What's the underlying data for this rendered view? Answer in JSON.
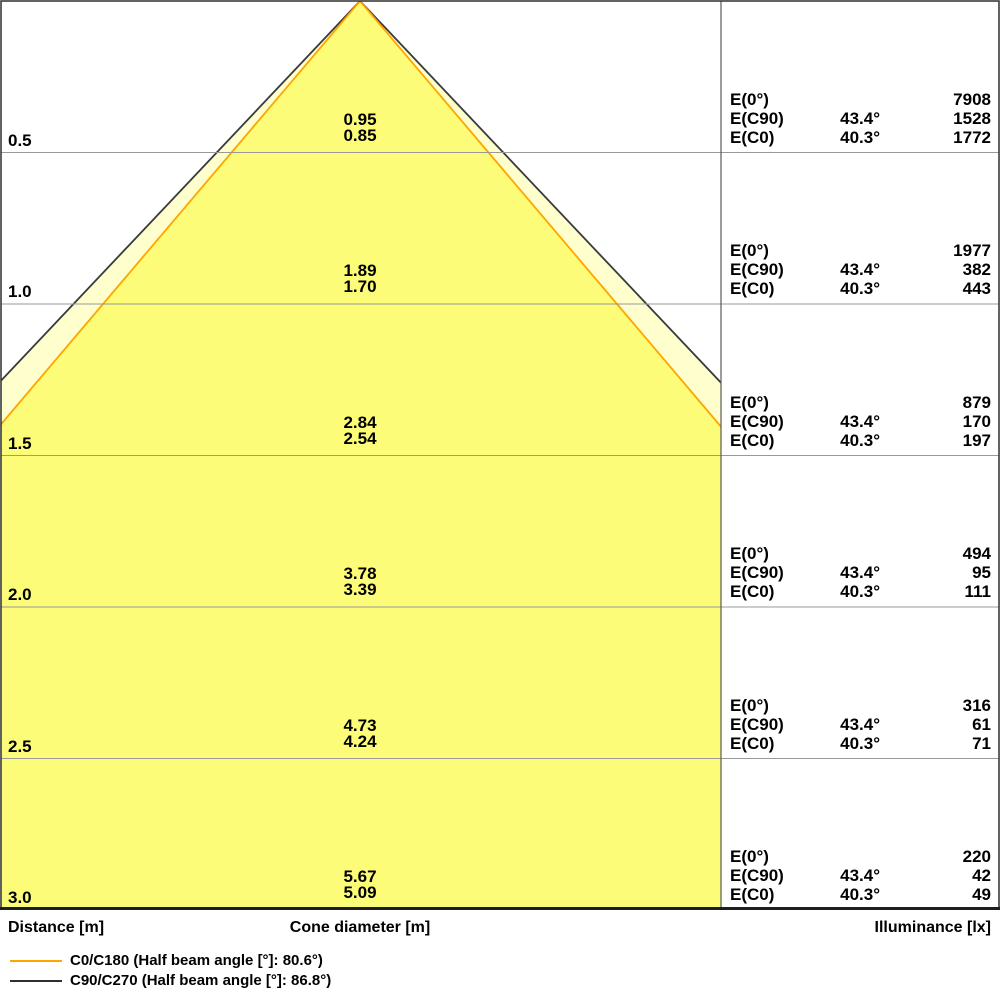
{
  "chart_data": {
    "type": "area",
    "title": "Light cone diagram (cone diameter and illuminance vs. distance)",
    "xlabel": "Distance [m]",
    "distances_m": [
      0.5,
      1.0,
      1.5,
      2.0,
      2.5,
      3.0
    ],
    "axis_ranges": {
      "distance_m": [
        0,
        3.0
      ]
    },
    "grid": true,
    "series": [
      {
        "name": "C90/C270",
        "half_beam_angle_deg": 86.8,
        "half_angle_deg": 43.4,
        "cone_diameter_m": [
          0.95,
          1.89,
          2.84,
          3.78,
          4.73,
          5.67
        ],
        "illuminance_lx": [
          1528,
          382,
          170,
          95,
          61,
          42
        ],
        "line_color": "#3A3A3A",
        "fill_color": "#FFFFCE"
      },
      {
        "name": "C0/C180",
        "half_beam_angle_deg": 80.6,
        "half_angle_deg": 40.3,
        "cone_diameter_m": [
          0.85,
          1.7,
          2.54,
          3.39,
          4.24,
          5.09
        ],
        "illuminance_lx": [
          1772,
          443,
          197,
          111,
          71,
          49
        ],
        "line_color": "#FFA500",
        "fill_color": "#FCFC78"
      }
    ],
    "E0_lx": [
      7908,
      1977,
      879,
      494,
      316,
      220
    ],
    "legend_position": "bottom-left"
  },
  "axes": {
    "distance": "Distance [m]",
    "cone_diameter": "Cone diameter [m]",
    "illuminance": "Illuminance [lx]"
  },
  "table": {
    "e0_label": "E(0°)",
    "ec90_label": "E(C90)",
    "ec0_label": "E(C0)",
    "ec90_angle": "43.4°",
    "ec0_angle": "40.3°",
    "blocks": [
      {
        "distance": "0.5",
        "d_outer": "0.95",
        "d_inner": "0.85",
        "e0": "7908",
        "ec90": "1528",
        "ec0": "1772"
      },
      {
        "distance": "1.0",
        "d_outer": "1.89",
        "d_inner": "1.70",
        "e0": "1977",
        "ec90": "382",
        "ec0": "443"
      },
      {
        "distance": "1.5",
        "d_outer": "2.84",
        "d_inner": "2.54",
        "e0": "879",
        "ec90": "170",
        "ec0": "197"
      },
      {
        "distance": "2.0",
        "d_outer": "3.78",
        "d_inner": "3.39",
        "e0": "494",
        "ec90": "95",
        "ec0": "111"
      },
      {
        "distance": "2.5",
        "d_outer": "4.73",
        "d_inner": "4.24",
        "e0": "316",
        "ec90": "61",
        "ec0": "71"
      },
      {
        "distance": "3.0",
        "d_outer": "5.67",
        "d_inner": "5.09",
        "e0": "220",
        "ec90": "42",
        "ec0": "49"
      }
    ]
  },
  "legend": [
    {
      "color": "#FFA500",
      "label": "C0/C180 (Half beam angle [°]: 80.6°)"
    },
    {
      "color": "#2F2F2F",
      "label": "C90/C270 (Half beam angle [°]: 86.8°)"
    }
  ],
  "colors": {
    "grid": "#999999",
    "divider": "#5A5A5A",
    "border": "#2F2F2F",
    "text": "#000000"
  }
}
